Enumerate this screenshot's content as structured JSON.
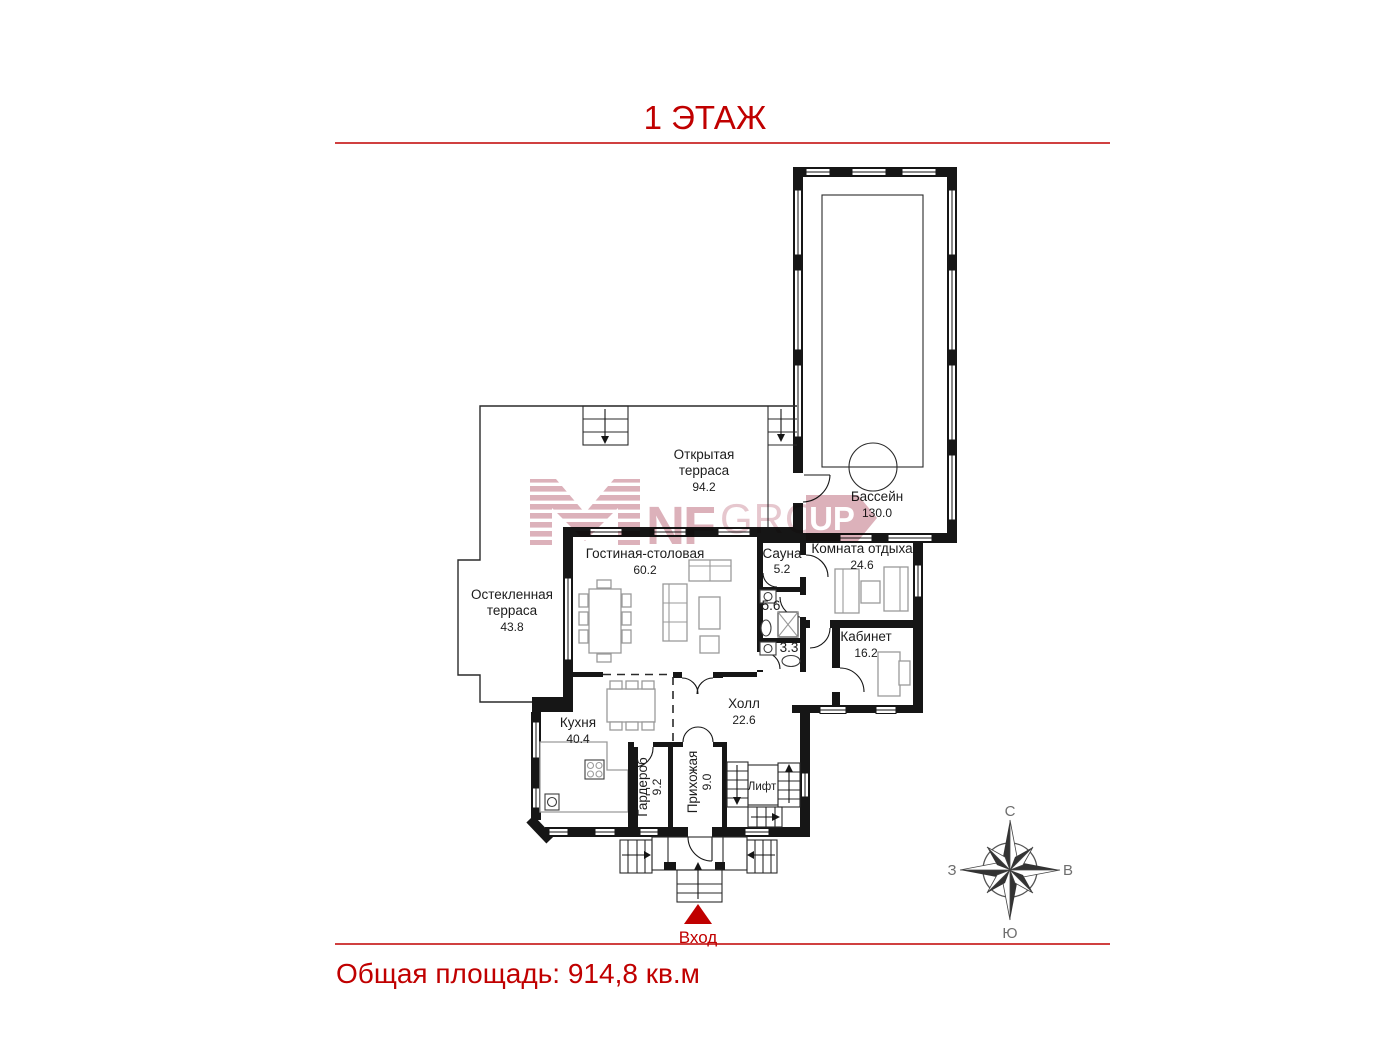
{
  "page": {
    "title": "1 ЭТАЖ",
    "total_area": "Общая площадь: 914,8 кв.м"
  },
  "entrance": {
    "label": "Вход"
  },
  "compass": {
    "n": "С",
    "s": "Ю",
    "w": "З",
    "e": "В"
  },
  "watermark": {
    "nf": "NF",
    "gro": "GRO",
    "up": "UP"
  },
  "rooms": {
    "open_terrace": {
      "line1": "Открытая",
      "line2": "терраса",
      "area": "94.2"
    },
    "pool": {
      "name": "Бассейн",
      "area": "130.0"
    },
    "glazed_terrace": {
      "line1": "Остекленная",
      "line2": "терраса",
      "area": "43.8"
    },
    "living_dining": {
      "name": "Гостиная-столовая",
      "area": "60.2"
    },
    "sauna": {
      "name": "Сауна",
      "area": "5.2"
    },
    "lounge": {
      "name": "Комната отдыха",
      "area": "24.6"
    },
    "shower": {
      "area": "5.6"
    },
    "wc": {
      "area": "3.3"
    },
    "office": {
      "name": "Кабинет",
      "area": "16.2"
    },
    "kitchen": {
      "name": "Кухня",
      "area": "40.4"
    },
    "hall": {
      "name": "Холл",
      "area": "22.6"
    },
    "wardrobe": {
      "name": "Гардероб",
      "area": "9.2"
    },
    "entry": {
      "name": "Прихожая",
      "area": "9.0"
    },
    "elevator": {
      "name": "Лифт"
    }
  },
  "colors": {
    "accent": "#c00000",
    "walls": "#161616",
    "watermark": "#cf93a0"
  }
}
